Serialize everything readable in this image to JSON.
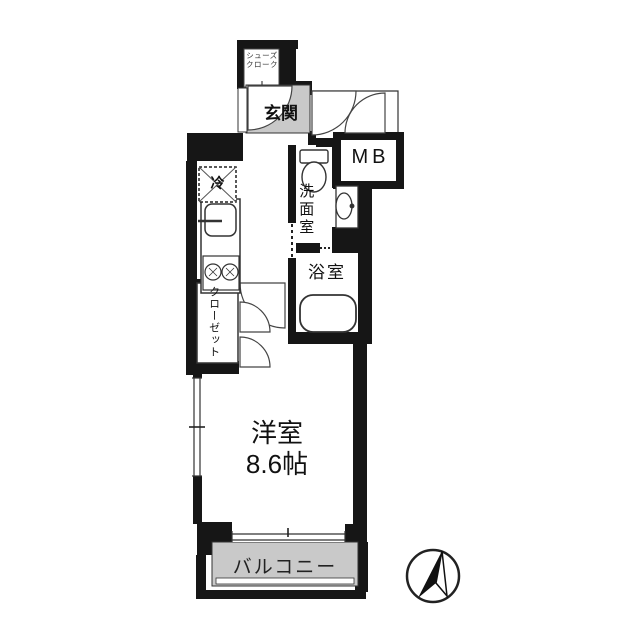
{
  "floor_plan": {
    "shoe_closet_label_line1": "シューズ",
    "shoe_closet_label_line2": "クローク",
    "entrance_label": "玄関",
    "meter_box_label": "MB",
    "refrigerator_label": "冷",
    "washroom_label": "洗面室",
    "bathroom_label": "浴室",
    "closet_label": "クローゼット",
    "main_room_name": "洋室",
    "main_room_size": "8.6帖",
    "balcony_label": "バルコニー",
    "compass": "north-arrow",
    "colors": {
      "wall": "#161616",
      "floor_gray": "#c9c9c9",
      "line": "#333333",
      "background": "#ffffff"
    }
  }
}
